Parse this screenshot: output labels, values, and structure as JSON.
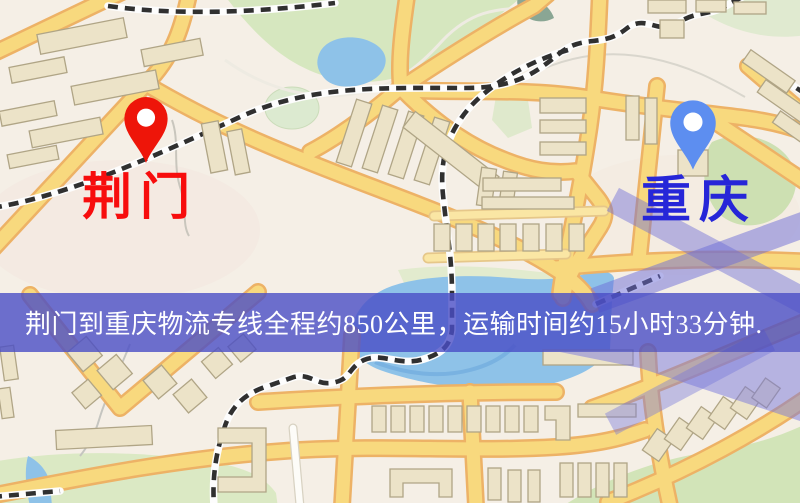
{
  "map": {
    "markers": [
      {
        "id": "origin",
        "label": "荆门",
        "pin_color": "#ee1509",
        "label_color": "#f70d0d"
      },
      {
        "id": "destination",
        "label": "重庆",
        "pin_color": "#5d8ef0",
        "label_color": "#2626d8"
      }
    ],
    "banner": {
      "text": "荆门到重庆物流专线全程约850公里，运输时间约15小时33分钟.",
      "background": "#4a4ec6",
      "text_color": "#ffffff"
    },
    "legend_colors": {
      "map_background": "#f5efe6",
      "road_fill": "#f8d97e",
      "road_casing": "#edb266",
      "water": "#8ec2e8",
      "park": "#d6e7bf",
      "building": "#ece3c8",
      "railway": "#303030",
      "overlay_purple": "#6c6cd8"
    }
  }
}
